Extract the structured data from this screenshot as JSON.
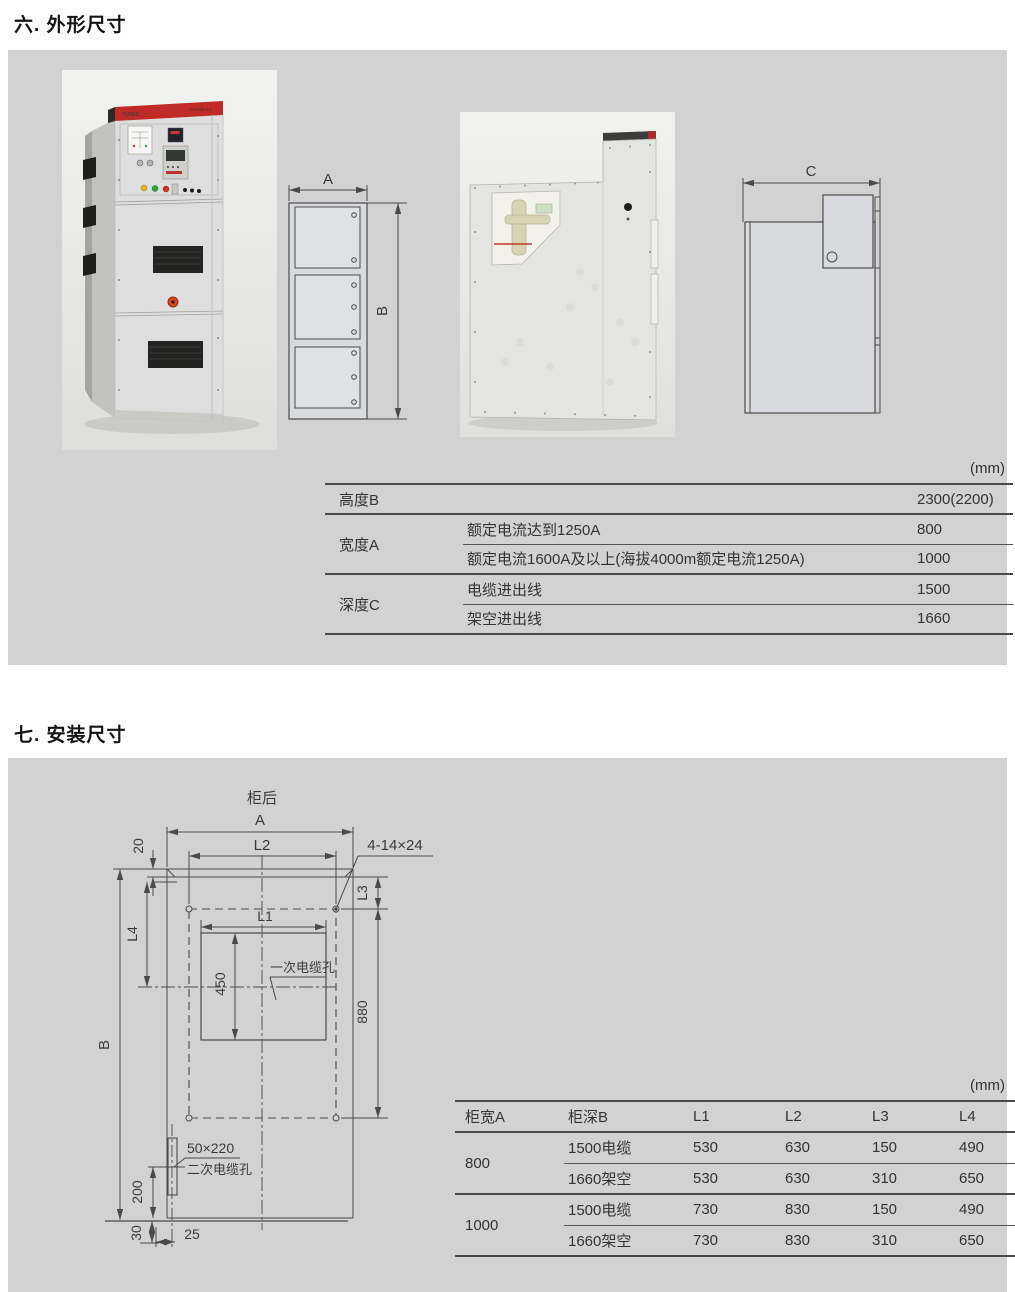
{
  "page": {
    "section6_title": "六. 外形尺寸",
    "section7_title": "七. 安装尺寸"
  },
  "photo": {
    "brand": "YUNER",
    "model": "KYN28-12"
  },
  "drawings": {
    "front": {
      "a": "A",
      "b": "B"
    },
    "side": {
      "c": "C"
    },
    "install": {
      "rear": "柜后",
      "a": "A",
      "b": "B",
      "l1": "L1",
      "l2": "L2",
      "l3": "L3",
      "l4": "L4",
      "d20": "20",
      "d450": "450",
      "d880": "880",
      "d200": "200",
      "d30": "30",
      "d25": "25",
      "holes": "4-14×24",
      "primary_hole": "一次电缆孔",
      "secondary_size": "50×220",
      "secondary_hole": "二次电缆孔"
    }
  },
  "dimension_table": {
    "unit": "(mm)",
    "height_row": {
      "label": "高度B",
      "value": "2300(2200)"
    },
    "width_group": {
      "label": "宽度A",
      "rows": [
        {
          "condition": "额定电流达到1250A",
          "value": "800"
        },
        {
          "condition": "额定电流1600A及以上(海拔4000m额定电流1250A)",
          "value": "1000"
        }
      ]
    },
    "depth_group": {
      "label": "深度C",
      "rows": [
        {
          "condition": "电缆进出线",
          "value": "1500"
        },
        {
          "condition": "架空进出线",
          "value": "1660"
        }
      ]
    }
  },
  "install_table": {
    "unit": "(mm)",
    "headers": [
      "柜宽A",
      "柜深B",
      "L1",
      "L2",
      "L3",
      "L4"
    ],
    "groups": [
      {
        "width": "800",
        "rows": [
          {
            "depth": "1500电缆",
            "l1": "530",
            "l2": "630",
            "l3": "150",
            "l4": "490"
          },
          {
            "depth": "1660架空",
            "l1": "530",
            "l2": "630",
            "l3": "310",
            "l4": "650"
          }
        ]
      },
      {
        "width": "1000",
        "rows": [
          {
            "depth": "1500电缆",
            "l1": "730",
            "l2": "830",
            "l3": "150",
            "l4": "490"
          },
          {
            "depth": "1660架空",
            "l1": "730",
            "l2": "830",
            "l3": "310",
            "l4": "650"
          }
        ]
      }
    ]
  },
  "colors": {
    "panel": "#d2d2d2",
    "line": "#4a4a4a",
    "brand_red": "#bf2b26"
  }
}
